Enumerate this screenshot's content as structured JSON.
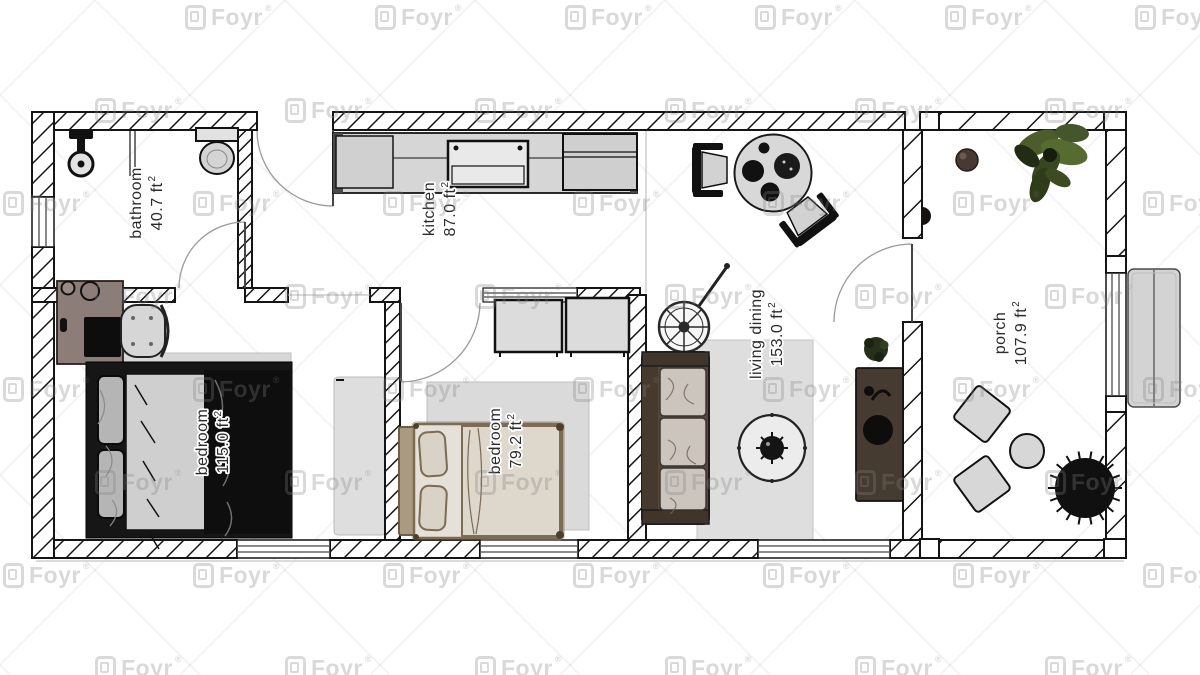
{
  "app": {
    "watermark_label": "Foyr",
    "watermark_reg": "®"
  },
  "rooms": [
    {
      "key": "bathroom",
      "name": "bathroom",
      "area": "40.7 ft",
      "area_sup": "2"
    },
    {
      "key": "kitchen",
      "name": "kitchen",
      "area": "87.0 ft",
      "area_sup": "2"
    },
    {
      "key": "bedroom_left",
      "name": "bedroom",
      "area": "115.0 ft",
      "area_sup": "2"
    },
    {
      "key": "bedroom_middle",
      "name": "bedroom",
      "area": "79.2 ft",
      "area_sup": "2"
    },
    {
      "key": "living_dining",
      "name": "living dining",
      "area": "153.0 ft",
      "area_sup": "2"
    },
    {
      "key": "porch",
      "name": "porch",
      "area": "107.9 ft",
      "area_sup": "2"
    }
  ],
  "colors": {
    "wall": "#141414",
    "floor": "#ffffff",
    "rug": "#d9d9d9",
    "counter": "#d6d6d6",
    "sofa": "#554739",
    "wood": "#8c7d78",
    "plant_green": "#4c5c2b",
    "label_text": "#2b2b2b",
    "watermark": "rgba(128,128,128,0.30)"
  }
}
